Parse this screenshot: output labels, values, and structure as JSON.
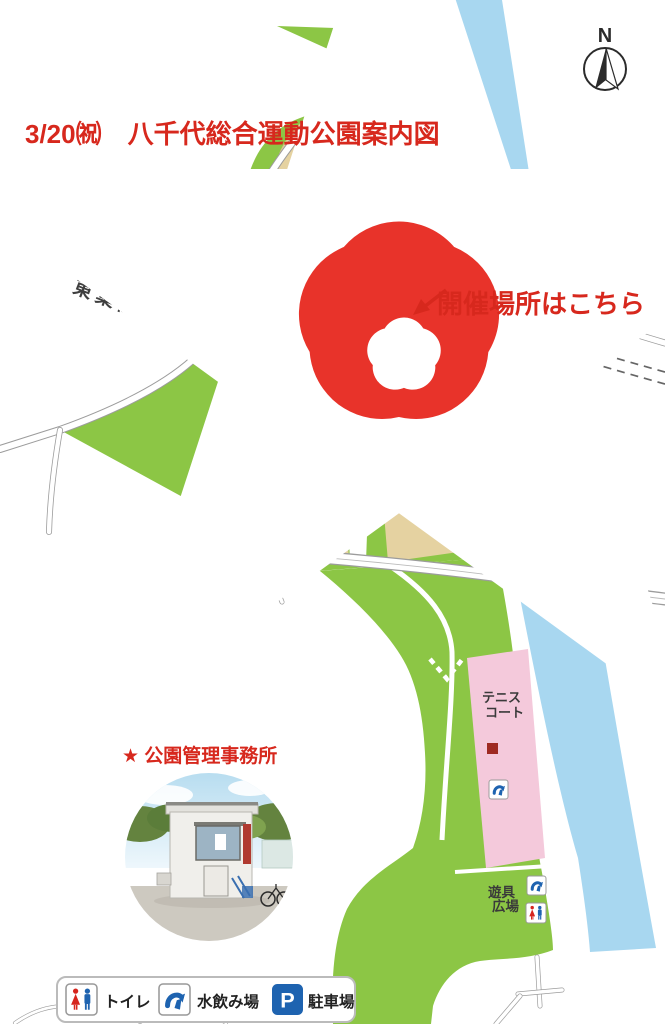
{
  "title": "3/20㈷　八千代総合運動公園案内図",
  "compass": {
    "label": "N"
  },
  "map": {
    "river_label": "新川",
    "railway_label": "東葉高速鉄道",
    "baseball_field": [
      "八千代",
      "総合運動公園",
      "野球場"
    ],
    "tennis_north": [
      "テニス",
      "コート"
    ],
    "tennis_south": [
      "テニス",
      "コート"
    ],
    "gymnasium": [
      "八千代市",
      "市民体育館"
    ],
    "plaza_label": "多目的広場",
    "playground": [
      "遊具",
      "広場"
    ],
    "event_callout": "開催場所はこちら"
  },
  "office": {
    "heading": "★ 公園管理事務所"
  },
  "legend": {
    "items": [
      {
        "icon": "toilet-icon",
        "label": "トイレ"
      },
      {
        "icon": "water-fountain-icon",
        "label": "水飲み場"
      },
      {
        "icon": "parking-icon",
        "label": "駐車場"
      }
    ]
  },
  "icons": {
    "parking_letter": "P"
  },
  "colors": {
    "park_green": "#8CC645",
    "river_blue": "#A8D7F0",
    "field_beige": "#E5D2A1",
    "court_pink": "#F4C9DB",
    "building_red": "#9E2A22",
    "parking_gray": "#B5B5B5",
    "accent_red": "#D7281D",
    "icon_blue": "#1E63B0",
    "star_orange": "#F6921E"
  }
}
